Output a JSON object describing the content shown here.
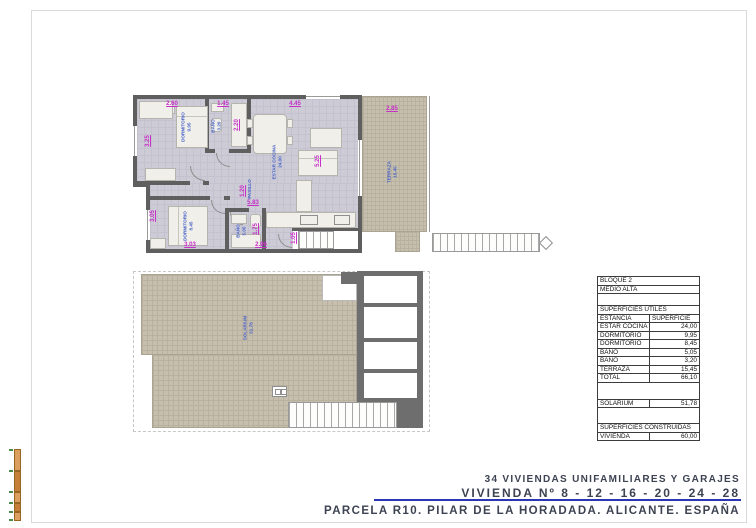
{
  "title_block": {
    "line1": "34 VIVIENDAS UNIFAMILIARES Y GARAJES",
    "line2": "VIVIENDA Nº 8 - 12 - 16 - 20 - 24 - 28",
    "line3": "PARCELA R10. PILAR DE LA HORADADA. ALICANTE. ESPAÑA"
  },
  "area_table": {
    "rows": [
      {
        "label": "BLOQUE 2",
        "value": ""
      },
      {
        "label": "MEDIO ALTA",
        "value": ""
      },
      {
        "label": "",
        "value": ""
      },
      {
        "label": "SUPERFICIES ÚTILES",
        "value": ""
      },
      {
        "label": "ESTANCIA",
        "value": "SUPERFICIE"
      },
      {
        "label": "ESTAR COCINA",
        "value": "24,00"
      },
      {
        "label": "DORMITORIO",
        "value": "9,95"
      },
      {
        "label": "DORMITORIO",
        "value": "8,45"
      },
      {
        "label": "BAÑO",
        "value": "5,05"
      },
      {
        "label": "BAÑO",
        "value": "3,20"
      },
      {
        "label": "TERRAZA",
        "value": "15,45"
      },
      {
        "label": "TOTAL",
        "value": "66,10"
      },
      {
        "label": "",
        "value": ""
      },
      {
        "label": "SOLARIUM",
        "value": "51,78"
      },
      {
        "label": "",
        "value": ""
      },
      {
        "label": "SUPERFICIES CONSTRUIDAS",
        "value": ""
      },
      {
        "label": "VIVIENDA",
        "value": "60,00"
      }
    ]
  },
  "upper_plan": {
    "rooms": {
      "dorm1": {
        "name": "DORMITORIO",
        "area": "9.95"
      },
      "bath1": {
        "name": "BAÑO",
        "area": "3.20"
      },
      "living": {
        "name": "ESTAR COCINA",
        "area": "24.00"
      },
      "hall": {
        "name": "PASILLO",
        "area": ""
      },
      "dorm2": {
        "name": "DORMITORIO",
        "area": "8.45"
      },
      "bath2": {
        "name": "BAÑO",
        "area": "5.05"
      },
      "terrace": {
        "name": "TERRAZA",
        "area": "15.45"
      }
    },
    "dims": {
      "top_dorm1": "2.60",
      "top_bath1": "1.45",
      "top_living": "4.45",
      "terrace_top": "2.85",
      "left_dorm1": "3.25",
      "bath1_depth": "2.20",
      "living_right": "5.25",
      "hall_width": "1.20",
      "hall_length": "5.83",
      "left_dorm2": "3.05",
      "bath2_width": "1.75",
      "bottom_dorm2": "3.03",
      "bottom_mid": "2.96",
      "porch": "1.05"
    }
  },
  "lower_plan": {
    "rooms": {
      "solarium": {
        "name": "SOLARIUM",
        "area": "51.78"
      }
    }
  },
  "colors": {
    "dimension_text": "#c62fc8",
    "room_label_text": "#4a63c8",
    "wall": "#5f5f5f",
    "floor": "#cccbd6",
    "tile": "#c7bfae",
    "accent_line": "#2b36b2",
    "title_text": "#3d4352"
  }
}
